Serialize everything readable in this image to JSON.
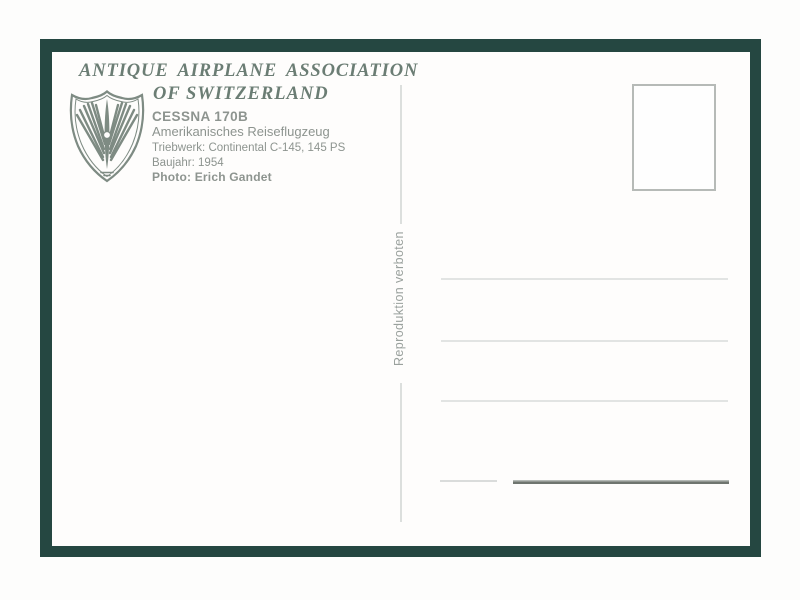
{
  "postcard": {
    "header": {
      "line1": "ANTIQUE AIRPLANE ASSOCIATION",
      "line2": "OF SWITZERLAND"
    },
    "details": {
      "model": "CESSNA 170B",
      "description": "Amerikanisches Reiseflugzeug",
      "engine": "Triebwerk: Continental C-145, 145 PS",
      "year": "Baujahr: 1954",
      "photo_credit": "Photo: Erich Gandet"
    },
    "note_vertical": "Reproduktion verboten",
    "logo": {
      "icon": "winged-propeller-shield-icon",
      "meaning": "Antique Airplane Association of Switzerland emblem"
    },
    "stamp_box": {
      "content": ""
    },
    "address_lines": [
      "",
      "",
      ""
    ],
    "colors": {
      "frame": "#254741",
      "header_text": "#6b7d74",
      "details_text": "#8d948f",
      "note_text": "#9aa19d",
      "address_line": "#e2e4e3",
      "signature_line_dark": "#6f756f",
      "card_background": "#fefdfc"
    }
  }
}
